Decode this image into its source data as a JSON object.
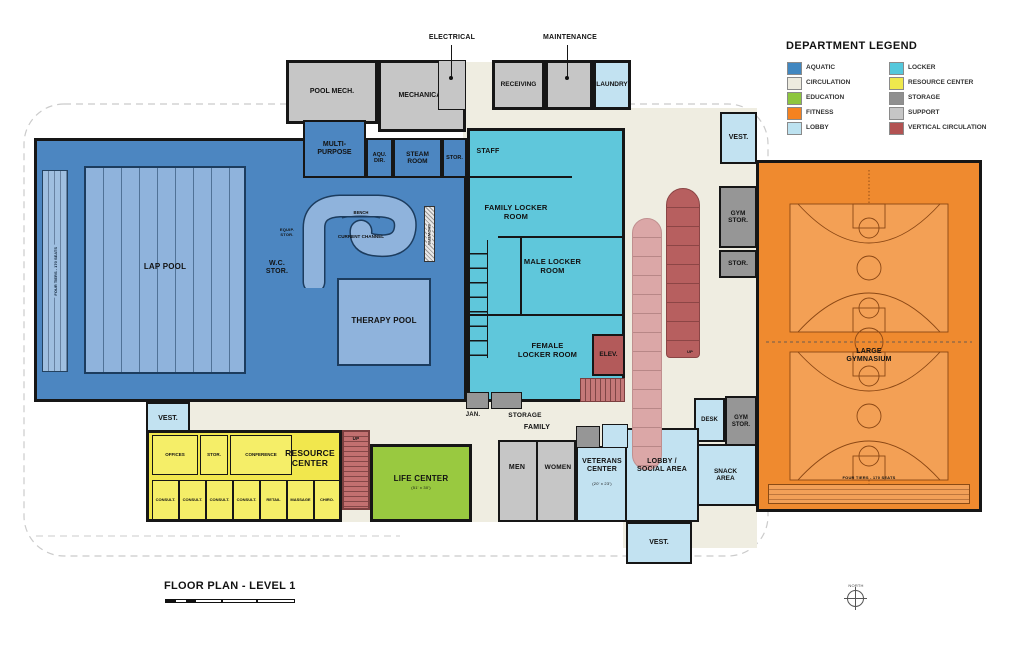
{
  "legend": {
    "title": "DEPARTMENT LEGEND",
    "col1": [
      {
        "label": "AQUATIC",
        "color": "#4187C0"
      },
      {
        "label": "CIRCULATION",
        "color": "#EDEBDF"
      },
      {
        "label": "EDUCATION",
        "color": "#8DC63F"
      },
      {
        "label": "FITNESS",
        "color": "#F58220"
      },
      {
        "label": "LOBBY",
        "color": "#BDE2F0"
      }
    ],
    "col2": [
      {
        "label": "LOCKER",
        "color": "#54C8DC"
      },
      {
        "label": "RESOURCE CENTER",
        "color": "#EFE94D"
      },
      {
        "label": "STORAGE",
        "color": "#8F8F8F"
      },
      {
        "label": "SUPPORT",
        "color": "#C6C6C6"
      },
      {
        "label": "VERTICAL CIRCULATION",
        "color": "#B25252"
      }
    ]
  },
  "title_block": {
    "title": "FLOOR PLAN - LEVEL 1"
  },
  "compass": {
    "label": "NORTH"
  },
  "annotations": {
    "electrical": "ELECTRICAL",
    "maintenance": "MAINTENANCE"
  },
  "labels": {
    "pool_mech": "POOL MECH.",
    "mechanical": "MECHANICAL",
    "receiving": "RECEIVING",
    "laundry": "LAUNDRY",
    "multi_purpose": "MULTI-\nPURPOSE",
    "aqu_dir": "AQU.\nDIR.",
    "steam_room": "STEAM\nROOM",
    "stor": "STOR.",
    "staff": "STAFF",
    "family_locker": "FAMILY LOCKER\nROOM",
    "male_locker": "MALE LOCKER\nROOM",
    "female_locker": "FEMALE\nLOCKER ROOM",
    "elev": "ELEV.",
    "up": "UP",
    "lap_pool": "LAP POOL",
    "wc_stor": "W.C.\nSTOR.",
    "equip_stor": "EQUIP.\nSTOR.",
    "bench": "BENCH",
    "current_channel": "CURRENT CHANNEL",
    "therapy_pool": "THERAPY POOL",
    "showers": "SHOWERS",
    "tiers_seats": "FOUR TIERS - 170 SEATS",
    "vest": "VEST.",
    "gym_stor": "GYM\nSTOR.",
    "large_gym": "LARGE\nGYMNASIUM",
    "desk": "DESK",
    "snack": "SNACK\nAREA",
    "lobby_social": "LOBBY /\nSOCIAL AREA",
    "jan": "JAN.",
    "storage": "STORAGE",
    "family": "FAMILY",
    "offices": "OFFICES",
    "conference": "CONFERENCE",
    "resource_center": "RESOURCE\nCENTER",
    "consult": "CONSULT.",
    "retail": "RETAIL",
    "massage": "MASSAGE",
    "chiro": "CHIRO.",
    "life_center": "LIFE CENTER",
    "life_center_dim": "(51' x 30')",
    "veterans_center": "VETERANS\nCENTER",
    "veterans_dim": "(20' x 23')"
  }
}
